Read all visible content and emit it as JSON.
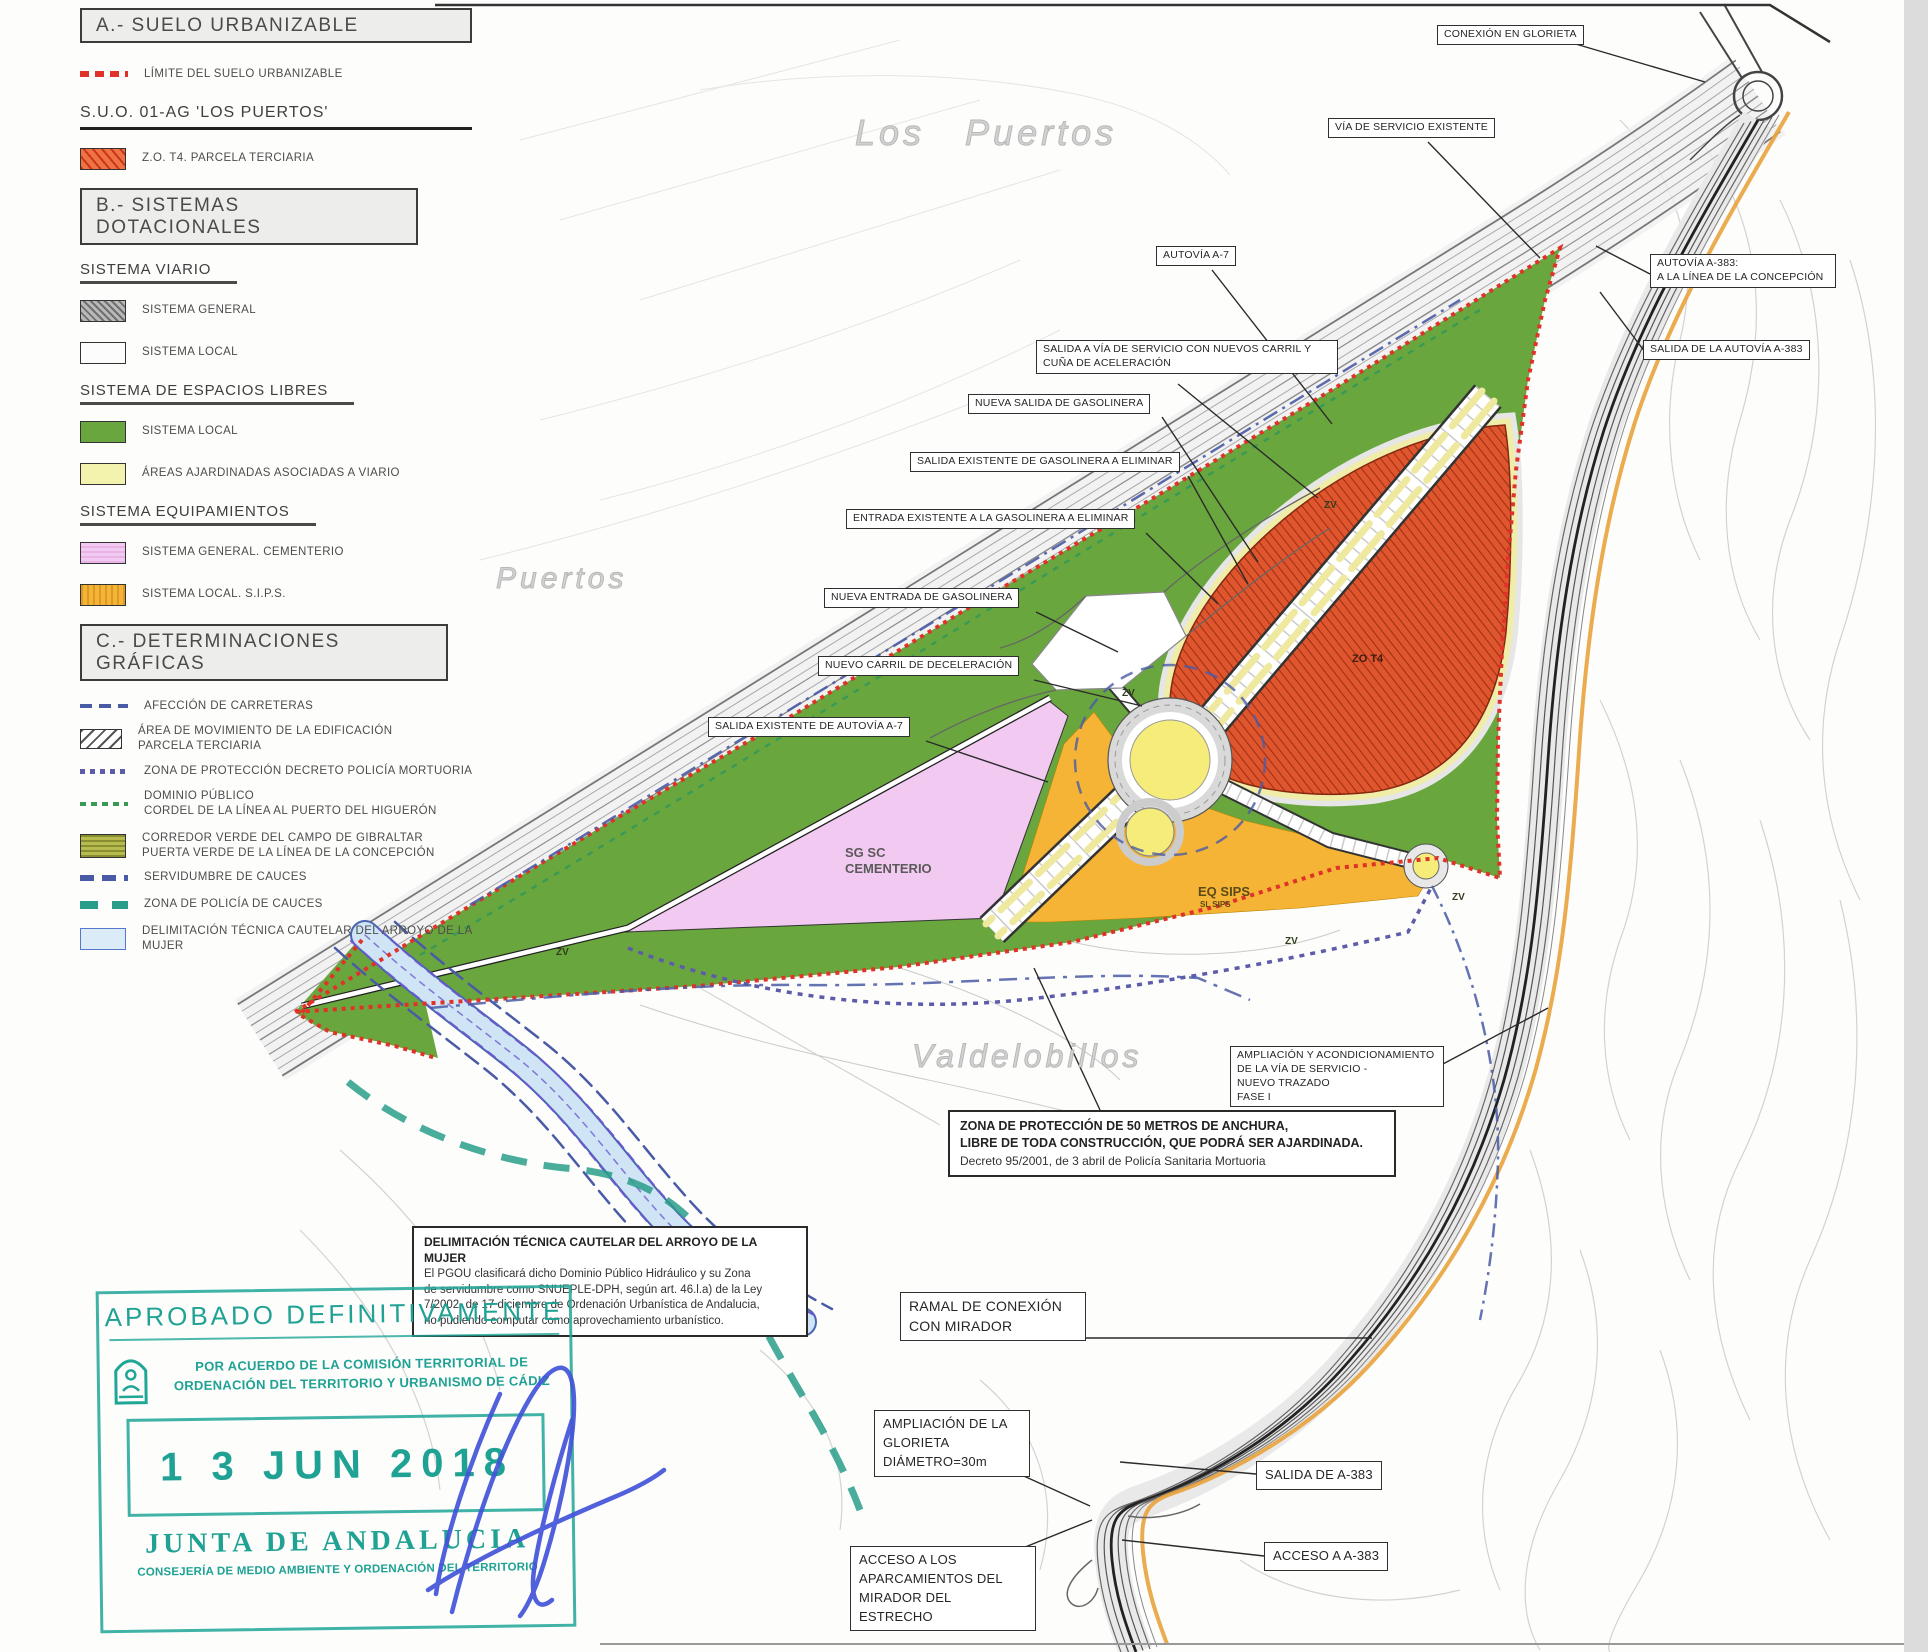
{
  "colors": {
    "limite_red": "#e03228",
    "parcela_orange": "#df562e",
    "green_local": "#6aa63e",
    "ajardinadas_yellow": "#f3f3ae",
    "cementerio_pink": "#f2c9f0",
    "sips_orange": "#f5b435",
    "corredor_olive": "#b8bc4e",
    "afeccion_blue": "#4a5ba6",
    "mortuoria_purple": "#5c5caa",
    "dominio_green": "#3a9a55",
    "cauces_teal": "#2a9d8a",
    "arroyo_blue": "#cfe4f5",
    "stamp_teal": "#20a696",
    "signature_blue": "#4353d9"
  },
  "legend": {
    "section_a": {
      "title": "A.- SUELO URBANIZABLE",
      "items": [
        {
          "label": "LÍMITE DEL SUELO URBANIZABLE"
        }
      ],
      "subsection": "S.U.O. 01-AG 'LOS PUERTOS'",
      "sub_items": [
        {
          "label": "Z.O. T4. PARCELA TERCIARIA"
        }
      ]
    },
    "section_b": {
      "title": "B.- SISTEMAS DOTACIONALES",
      "groups": [
        {
          "heading": "SISTEMA VIARIO",
          "items": [
            {
              "label": "SISTEMA GENERAL"
            },
            {
              "label": "SISTEMA LOCAL"
            }
          ]
        },
        {
          "heading": "SISTEMA DE ESPACIOS LIBRES",
          "items": [
            {
              "label": "SISTEMA LOCAL"
            },
            {
              "label": "ÁREAS AJARDINADAS ASOCIADAS A VIARIO"
            }
          ]
        },
        {
          "heading": "SISTEMA EQUIPAMIENTOS",
          "items": [
            {
              "label": "SISTEMA GENERAL. CEMENTERIO"
            },
            {
              "label": "SISTEMA LOCAL. S.I.P.S."
            }
          ]
        }
      ]
    },
    "section_c": {
      "title": "C.- DETERMINACIONES GRÁFICAS",
      "items": [
        {
          "label": "AFECCIÓN DE CARRETERAS"
        },
        {
          "label": "ÁREA DE MOVIMIENTO DE LA EDIFICACIÓN\nPARCELA TERCIARIA"
        },
        {
          "label": "ZONA DE PROTECCIÓN DECRETO POLICÍA MORTUORIA"
        },
        {
          "label": "DOMINIO PÚBLICO\nCORDEL DE LA LÍNEA AL PUERTO DEL HIGUERÓN"
        },
        {
          "label": "CORREDOR VERDE DEL CAMPO DE GIBRALTAR\nPUERTA VERDE DE LA LÍNEA DE LA CONCEPCIÓN"
        },
        {
          "label": "SERVIDUMBRE DE CAUCES"
        },
        {
          "label": "ZONA DE POLICÍA DE CAUCES"
        },
        {
          "label": "DELIMITACIÓN TÉCNICA CAUTELAR DEL ARROYO DE LA MUJER"
        }
      ]
    }
  },
  "map": {
    "place_names": [
      {
        "text": "Los  Puertos"
      },
      {
        "text": "Puertos"
      },
      {
        "text": "Valdelobillos"
      }
    ],
    "zone_labels": [
      {
        "text": "SG SC\nCEMENTERIO"
      },
      {
        "text": "EQ SIPS"
      },
      {
        "text": "SL SIPS"
      },
      {
        "text": "ZO T4"
      },
      {
        "text": "ZV"
      },
      {
        "text": "ZV"
      },
      {
        "text": "ZV"
      },
      {
        "text": "ZV"
      },
      {
        "text": "ZV"
      }
    ],
    "callouts": [
      {
        "text": "CONEXIÓN EN GLORIETA"
      },
      {
        "text": "VÍA DE SERVICIO EXISTENTE"
      },
      {
        "text": "AUTOVÍA A-7"
      },
      {
        "text": "AUTOVÍA A-383:\nA LA LÍNEA DE LA CONCEPCIÓN"
      },
      {
        "text": "SALIDA DE LA AUTOVÍA A-383"
      },
      {
        "text": "SALIDA A VÍA DE SERVICIO CON NUEVOS CARRIL Y CUÑA DE ACELERACIÓN"
      },
      {
        "text": "NUEVA SALIDA DE GASOLINERA"
      },
      {
        "text": "SALIDA EXISTENTE DE GASOLINERA A ELIMINAR"
      },
      {
        "text": "ENTRADA EXISTENTE A LA GASOLINERA A ELIMINAR"
      },
      {
        "text": "NUEVA ENTRADA DE GASOLINERA"
      },
      {
        "text": "NUEVO CARRIL DE DECELERACIÓN"
      },
      {
        "text": "SALIDA EXISTENTE DE AUTOVÍA A-7"
      },
      {
        "text": "AMPLIACIÓN Y ACONDICIONAMIENTO\nDE LA VÍA DE SERVICIO -\nNUEVO TRAZADO\nFASE I"
      },
      {
        "text": "RAMAL DE CONEXIÓN\nCON MIRADOR"
      },
      {
        "text": "AMPLIACIÓN DE LA\nGLORIETA\nDIÁMETRO=30m"
      },
      {
        "text": "SALIDA DE A-383"
      },
      {
        "text": "ACCESO A A-383"
      },
      {
        "text": "ACCESO A LOS\nAPARCAMIENTOS DEL\nMIRADOR DEL ESTRECHO"
      }
    ],
    "notes": [
      {
        "title": "ZONA DE PROTECCIÓN DE 50 METROS DE ANCHURA,\nLIBRE DE TODA CONSTRUCCIÓN, QUE PODRÁ SER AJARDINADA.",
        "body": "Decreto 95/2001, de 3 abril de Policía Sanitaria Mortuoria"
      },
      {
        "title": "DELIMITACIÓN TÉCNICA CAUTELAR DEL ARROYO DE LA MUJER",
        "body": "El PGOU clasificará dicho Dominio Público Hidráulico y su Zona\nde servidumbre como SNUEPLE-DPH, según art. 46.l.a) de la Ley\n7/2002, de 17 diciembre de Ordenación Urbanística de Andalucia,\nno pudiendo computar como aprovechamiento urbanístico."
      }
    ]
  },
  "stamp": {
    "line1": "APROBADO DEFINITIVAMENTE",
    "line2": "POR ACUERDO DE LA COMISIÓN TERRITORIAL DE",
    "line3": "ORDENACIÓN DEL TERRITORIO Y URBANISMO DE CÁDIZ",
    "date": "1 3 JUN 2018",
    "org": "JUNTA DE ANDALUCIA",
    "dept": "CONSEJERÍA DE MEDIO AMBIENTE Y ORDENACIÓN DEL TERRITORIO"
  }
}
